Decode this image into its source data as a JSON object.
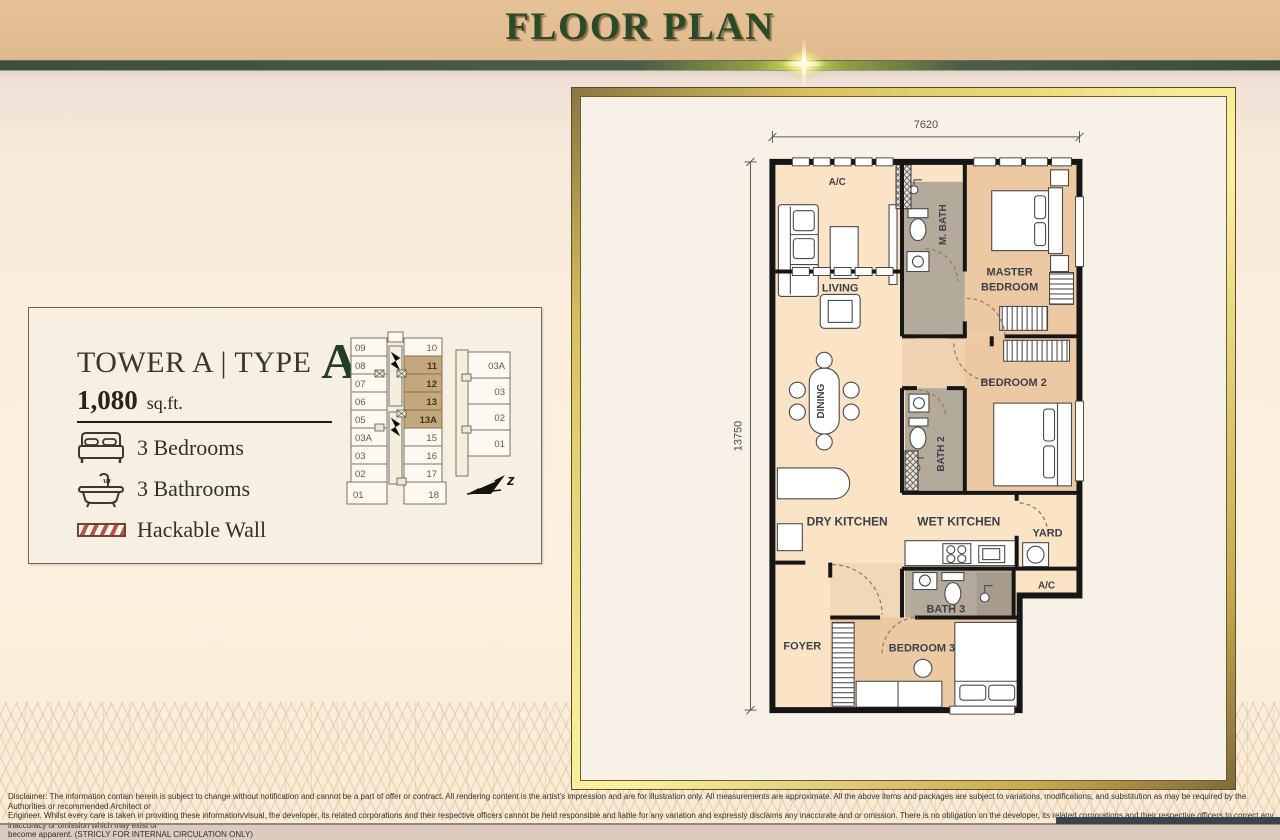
{
  "header": {
    "title": "FLOOR PLAN"
  },
  "card": {
    "tower_label": "TOWER A | TYPE",
    "type_letter": "A",
    "area_value": "1,080",
    "area_unit": "sq.ft.",
    "features": [
      {
        "icon": "bed-icon",
        "label": "3 Bedrooms"
      },
      {
        "icon": "bathtub-icon",
        "label": "3 Bathrooms"
      },
      {
        "icon": "hatched-wall-icon",
        "label": "Hackable Wall"
      }
    ]
  },
  "keyplan": {
    "left_units": [
      "09",
      "08",
      "07",
      "06",
      "05",
      "03A",
      "03",
      "02",
      "01"
    ],
    "right_units": [
      "10",
      "11",
      "12",
      "13",
      "13A",
      "15",
      "16",
      "17",
      "18"
    ],
    "highlighted_units": [
      "11",
      "12",
      "13",
      "13A"
    ],
    "annex_units": [
      "03A",
      "03",
      "02",
      "01"
    ],
    "highlight_color": "#c2a87c",
    "compass_label": "z"
  },
  "floorplan": {
    "dim_width": "7620",
    "dim_height": "13750",
    "rooms": {
      "ac_top": "A/C",
      "living": "LIVING",
      "m_bath": "M. BATH",
      "master_line1": "MASTER",
      "master_line2": "BEDROOM",
      "dining": "DINING",
      "bedroom2": "BEDROOM 2",
      "bath2": "BATH 2",
      "dry_kitchen": "DRY KITCHEN",
      "wet_kitchen": "WET KITCHEN",
      "yard": "YARD",
      "ac_right": "A/C",
      "bath3": "BATH 3",
      "foyer": "FOYER",
      "bedroom3": "BEDROOM 3"
    },
    "colors": {
      "open_area": "#fbe3c6",
      "bedroom": "#ecc9a3",
      "bath": "#b4aa9c",
      "wall": "#161616"
    }
  },
  "disclaimer": {
    "line1": "Disclaimer: The information contain herein is subject to change without notification and cannot be a part of offer or contract. All rendering content is the artist's impression and are for illustration only. All measurements are approximate. All the above items and packages are subject to variations, modifications, and substitution as may be required by the Authorities or recommended Architect or",
    "line2": "Engineer. Whilst every care is taken in providing these information/visual, the developer, its related corporations and their respective officers cannot be held responsible and liable for any variation and expressly disclaims any inaccurate and or omission.  There is no obligation on the developer, its related corporations and their respective officers to correct any inaccuracy or omission which may exist or",
    "line3": "become apparent. (STRICLY FOR INTERNAL CIRCULATION ONLY)"
  }
}
